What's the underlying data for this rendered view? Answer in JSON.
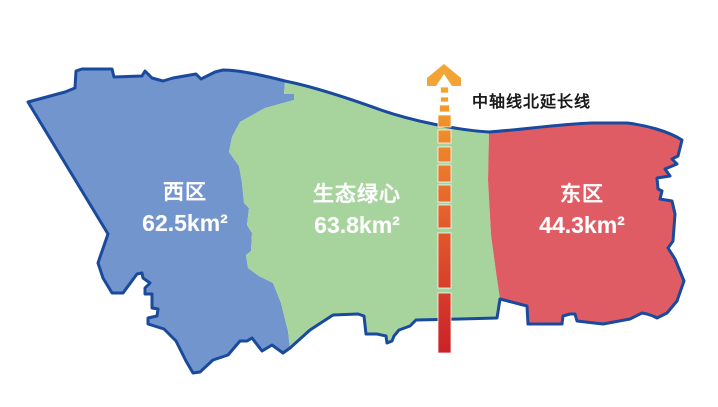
{
  "map": {
    "regions": [
      {
        "id": "west",
        "name": "西区",
        "area": "62.5km²"
      },
      {
        "id": "green-heart",
        "name": "生态绿心",
        "area": "63.8km²"
      },
      {
        "id": "east",
        "name": "东区",
        "area": "44.3km²"
      }
    ],
    "axis_label": "中轴线北延长线"
  },
  "colors": {
    "west_fill": "#7195CC",
    "center_fill": "#A7D49D",
    "east_fill": "#E05C64",
    "outline": "#1A4A9E",
    "axis_top": "#F5A52D",
    "axis_mid": "#E4602B",
    "axis_bottom": "#CB2129",
    "arrow": "#F2A437",
    "label_text": "#FFFFFF",
    "axis_label_text": "#1A1A1A",
    "background": "#FFFFFF"
  }
}
